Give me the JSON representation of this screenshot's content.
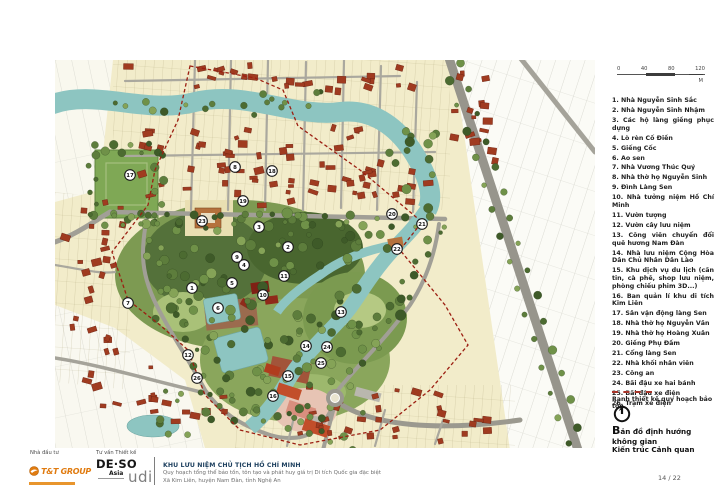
{
  "scale_bar": {
    "ticks": [
      "0",
      "40",
      "80",
      "120"
    ],
    "unit": "M"
  },
  "legend": {
    "items": [
      "1. Nhà Nguyễn Sinh Sắc",
      "2. Nhà Nguyễn Sinh Nhậm",
      "3. Các hộ làng giềng phục dựng",
      "4. Lò rèn Cố Điền",
      "5. Giếng Cốc",
      "6. Ao sen",
      "7. Nhà Vương Thúc Quý",
      "8. Nhà thờ họ Nguyễn Sinh",
      "9. Đình Làng Sen",
      "10. Nhà tưởng niệm Hồ Chí Minh",
      "11. Vườn tượng",
      "12. Vườn cây lưu niệm",
      "13. Công viên chuyển đổi quê hương Nam Đàn",
      "14. Nhà lưu niệm Cộng Hòa Dân Chủ Nhân Dân Lào",
      "15. Khu dịch vụ du lịch (căn tin, cà phê, shop lưu niệm, phòng chiếu phim 3D...)",
      "16. Ban quản lí khu di tích Kim Liên",
      "17. Sân vận động làng Sen",
      "18. Nhà thờ họ Nguyễn Văn",
      "19. Nhà thờ họ Hoàng Xuân",
      "20. Giếng Phụ Đầm",
      "21. Cổng làng Sen",
      "22. Nhà khối nhân viên",
      "23. Công an",
      "24. Bãi đậu xe hai bánh",
      "25. Bãi đậu xe điện",
      "26. Trạm xe điện"
    ]
  },
  "boundary_note": {
    "label": "Ranh thiết kế quy hoạch bảo tồn"
  },
  "map_title": {
    "first_letter": "B",
    "rest_line1": "ản đồ định hướng không gian",
    "line2": "Kiến trúc Cảnh quan"
  },
  "map": {
    "markers": [
      {
        "n": "1",
        "x": 137,
        "y": 228
      },
      {
        "n": "2",
        "x": 233,
        "y": 187
      },
      {
        "n": "3",
        "x": 204,
        "y": 167
      },
      {
        "n": "4",
        "x": 189,
        "y": 205
      },
      {
        "n": "5",
        "x": 177,
        "y": 223
      },
      {
        "n": "6",
        "x": 163,
        "y": 248
      },
      {
        "n": "7",
        "x": 73,
        "y": 243
      },
      {
        "n": "8",
        "x": 180,
        "y": 107
      },
      {
        "n": "9",
        "x": 182,
        "y": 197
      },
      {
        "n": "10",
        "x": 208,
        "y": 235
      },
      {
        "n": "11",
        "x": 229,
        "y": 216
      },
      {
        "n": "12",
        "x": 133,
        "y": 295
      },
      {
        "n": "13",
        "x": 286,
        "y": 252
      },
      {
        "n": "14",
        "x": 251,
        "y": 286
      },
      {
        "n": "15",
        "x": 233,
        "y": 316
      },
      {
        "n": "16",
        "x": 218,
        "y": 336
      },
      {
        "n": "17",
        "x": 75,
        "y": 115
      },
      {
        "n": "18",
        "x": 217,
        "y": 111
      },
      {
        "n": "19",
        "x": 188,
        "y": 141
      },
      {
        "n": "20",
        "x": 337,
        "y": 154
      },
      {
        "n": "21",
        "x": 367,
        "y": 164
      },
      {
        "n": "22",
        "x": 342,
        "y": 189
      },
      {
        "n": "23",
        "x": 147,
        "y": 161
      },
      {
        "n": "24",
        "x": 272,
        "y": 287
      },
      {
        "n": "25",
        "x": 266,
        "y": 303
      },
      {
        "n": "26",
        "x": 142,
        "y": 318
      }
    ]
  },
  "footer": {
    "investor_label": "Nhà đầu tư",
    "consultant_label": "Tư vấn Thiết kế",
    "tnt_name": "T&T GROUP",
    "deso_line1": "DE·SO",
    "deso_line2": "Asia",
    "udi": "udi",
    "project_title": "KHU LƯU NIỆM CHỦ TỊCH HỒ CHÍ MINH",
    "project_sub1": "Quy hoạch tổng thể bảo tồn, tôn tạo và phát huy giá trị Di tích Quốc gia đặc biệt",
    "project_sub2": "Xã Kim Liên, huyện Nam Đàn, tỉnh Nghệ An",
    "page_number": "14 / 22"
  },
  "colors": {
    "village_cream": "#f2ecca",
    "building_red": "#a03b20",
    "water_teal": "#8dc5c1",
    "park_green": "#7d9a52",
    "road_gray": "#a19f96",
    "boundary_red": "#9c1f12",
    "accent_orange": "#e07b10"
  }
}
